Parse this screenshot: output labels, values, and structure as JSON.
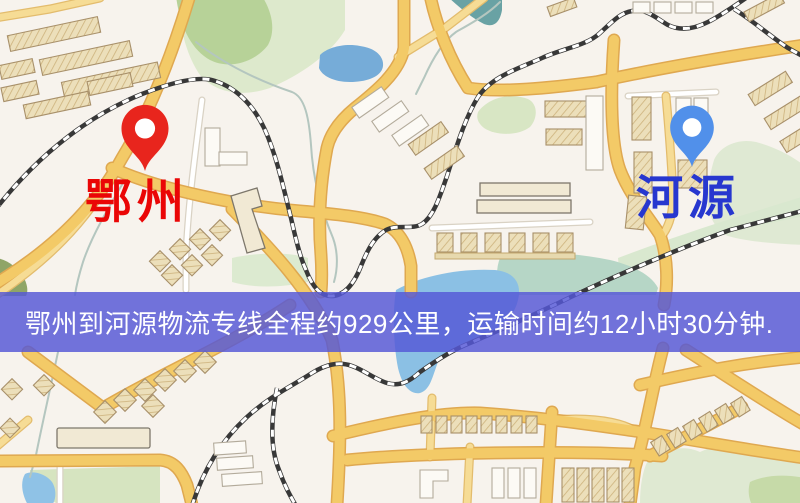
{
  "banner": {
    "text": "鄂州到河源物流专线全程约929公里，运输时间约12小时30分钟.",
    "distance_km": "929",
    "duration": "12小时30分钟",
    "background_color": "#5658d6",
    "text_color": "#ffffff"
  },
  "markers": {
    "origin": {
      "label": "鄂州",
      "pin_color": "#e8251d",
      "label_color": "#ea0606"
    },
    "destination": {
      "label": "河源",
      "pin_color": "#5190ea",
      "label_color": "#2737cf"
    }
  },
  "map": {
    "colors": {
      "background": "#f7f3ed",
      "road_major": "#f3ca67",
      "road_casing": "#dfa850",
      "road_minor": "#f6dc95",
      "railway": "#383838",
      "park_pale": "#dce9cc",
      "park_medium": "#b7d298",
      "water": "#8bc0e4",
      "building_tan": "#ecdfba",
      "building_white": "#fcfaf5"
    }
  }
}
